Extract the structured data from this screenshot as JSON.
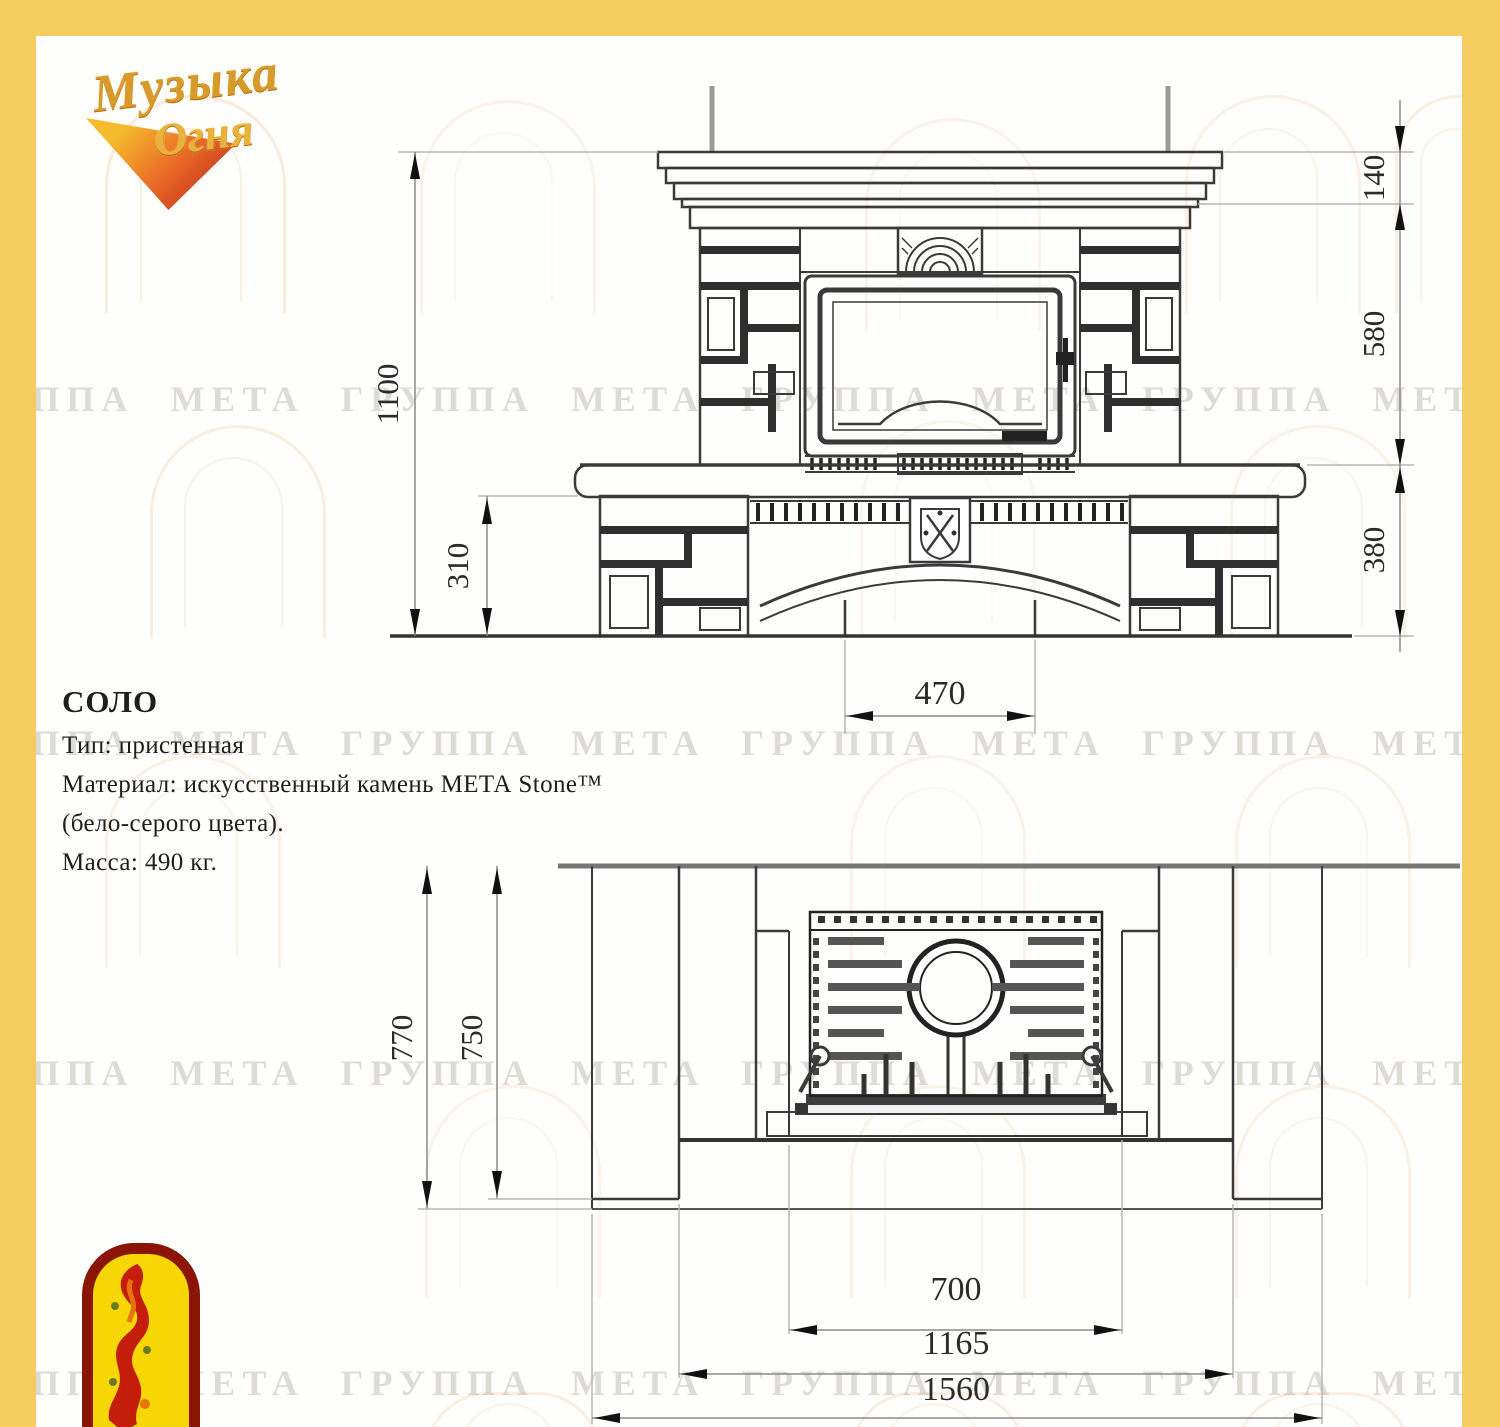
{
  "logo": {
    "word1": "Музыка",
    "word2": "Огня"
  },
  "watermark": {
    "text": "ГРУППА МЕТА ГРУППА МЕТА ГРУППА МЕТА ГРУППА МЕТА ГРУППА МЕТА"
  },
  "specs": {
    "title": "СОЛО",
    "type": "Тип: пристенная",
    "material1": "Материал: искусственный камень МЕТА Stone™",
    "material2": "(бело-серого цвета).",
    "mass": "Масса: 490 кг."
  },
  "front_view": {
    "dims": {
      "total_height": "1100",
      "hearth_height": "310",
      "mantel": "140",
      "middle": "580",
      "base": "380",
      "opening": "470"
    }
  },
  "plan_view": {
    "dims": {
      "total_depth": "770",
      "bench_depth": "750",
      "opening": "700",
      "bench_width": "1165",
      "total_width": "1560"
    }
  },
  "colors": {
    "frame_yellow": "#F5CC5F",
    "emblem_red": "#C41E0A",
    "emblem_yellow": "#F6D705",
    "logo_gold": "#D79A2B"
  }
}
